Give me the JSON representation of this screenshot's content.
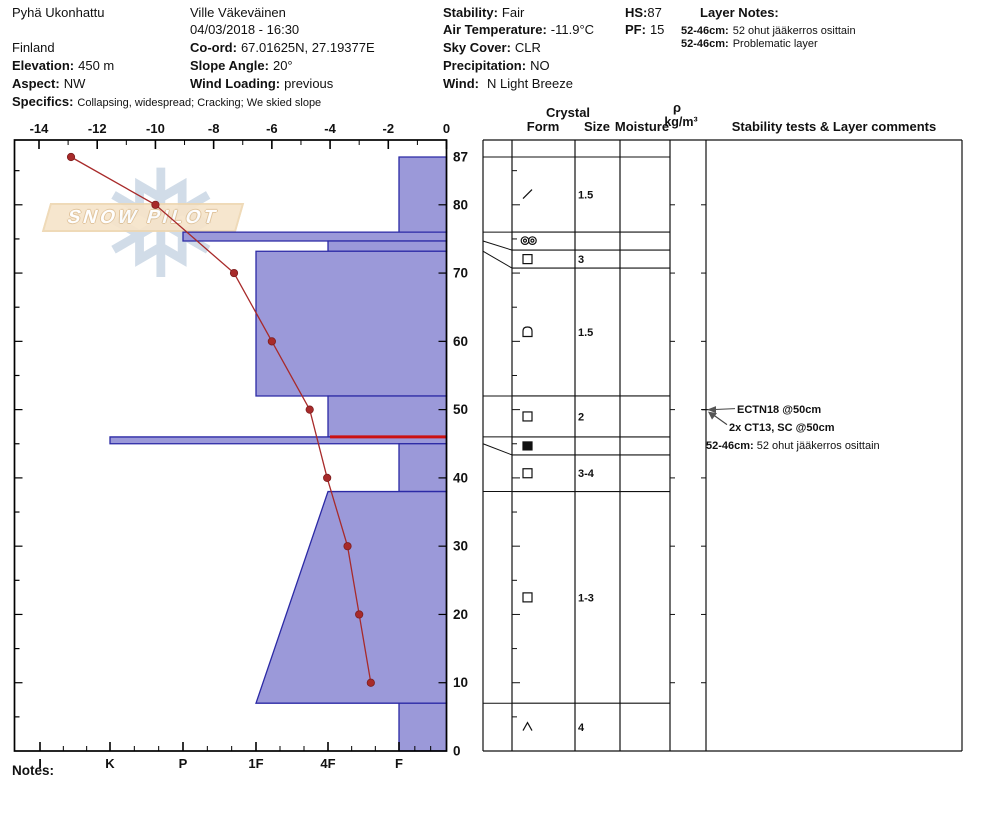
{
  "title_block": {
    "location": "Pyhä Ukonhattu",
    "country": "Finland",
    "elevation_label": "Elevation:",
    "elevation": "450 m",
    "aspect_label": "Aspect:",
    "aspect": "NW",
    "specifics_label": "Specifics:",
    "specifics": "Collapsing, widespread;  Cracking;  We skied slope",
    "observer": "Ville Väkeväinen",
    "datetime": "04/03/2018 - 16:30",
    "coord_label": "Co-ord:",
    "coord": "67.01625N, 27.19377E",
    "slope_angle_label": "Slope Angle:",
    "slope_angle": "20°",
    "wind_loading_label": "Wind Loading:",
    "wind_loading": "previous",
    "stability_label": "Stability:",
    "stability": "Fair",
    "air_temperature_label": "Air Temperature:",
    "air_temperature": "-11.9°C",
    "sky_cover_label": "Sky Cover:",
    "sky_cover": "CLR",
    "precipitation_label": "Precipitation:",
    "precipitation": "NO",
    "wind_label": "Wind:",
    "wind": "N Light Breeze",
    "hs_label": "HS:",
    "hs": "87",
    "pf_label": "PF:",
    "pf": "15",
    "layer_notes_title": "Layer Notes:",
    "layer_notes": [
      {
        "range": "52-46cm:",
        "text": "52 ohut jääkerros osittain"
      },
      {
        "range": "52-46cm:",
        "text": "Problematic layer"
      }
    ]
  },
  "watermark": {
    "text": "SNOW PILOT"
  },
  "notes_label": "Notes:",
  "chart_data": {
    "type": "snow-profile",
    "temperature_axis": {
      "tick_values": [
        -14,
        -12,
        -10,
        -8,
        -6,
        -4,
        -2,
        0
      ],
      "range": [
        -14,
        0
      ],
      "unit": "°C"
    },
    "depth_axis": {
      "tick_values": [
        87,
        80,
        70,
        60,
        50,
        40,
        30,
        20,
        10,
        0
      ],
      "range": [
        0,
        87
      ],
      "unit": "cm"
    },
    "hardness_axis": {
      "categories": [
        "I",
        "K",
        "P",
        "1F",
        "4F",
        "F"
      ]
    },
    "temperature_series": [
      {
        "depth_cm": 87,
        "temp_c": -12.9
      },
      {
        "depth_cm": 80,
        "temp_c": -10.0
      },
      {
        "depth_cm": 70,
        "temp_c": -7.3
      },
      {
        "depth_cm": 60,
        "temp_c": -6.0
      },
      {
        "depth_cm": 50,
        "temp_c": -4.7
      },
      {
        "depth_cm": 40,
        "temp_c": -4.1
      },
      {
        "depth_cm": 30,
        "temp_c": -3.4
      },
      {
        "depth_cm": 20,
        "temp_c": -3.0
      },
      {
        "depth_cm": 10,
        "temp_c": -2.6
      }
    ],
    "hardness_layers": [
      {
        "top_cm": 87,
        "bottom_cm": 76,
        "hardness": "F"
      },
      {
        "top_cm": 76,
        "bottom_cm": 74.7,
        "hardness": "P"
      },
      {
        "top_cm": 74.7,
        "bottom_cm": 73.2,
        "hardness": "4F"
      },
      {
        "top_cm": 73.2,
        "bottom_cm": 52,
        "hardness": "1F"
      },
      {
        "top_cm": 52,
        "bottom_cm": 46,
        "hardness": "4F"
      },
      {
        "top_cm": 46,
        "bottom_cm": 45,
        "hardness": "K"
      },
      {
        "top_cm": 45,
        "bottom_cm": 38,
        "hardness": "F"
      },
      {
        "top_cm": 38,
        "bottom_cm": 7,
        "hardness_top": "4F",
        "hardness_bottom": "1F"
      },
      {
        "top_cm": 7,
        "bottom_cm": 0,
        "hardness": "F"
      }
    ],
    "problem_layer_depth_cm": 46
  },
  "layer_table": {
    "header": {
      "crystal": "Crystal",
      "form": "Form",
      "size": "Size",
      "moisture": "Moisture",
      "rho": "ρ",
      "rho_unit": "kg/m³",
      "comments": "Stability tests & Layer comments"
    },
    "rows": [
      {
        "top_cm": 87,
        "bottom_cm": 76,
        "form": "DF",
        "size": "1.5"
      },
      {
        "top_cm": 76,
        "bottom_cm": 74.7,
        "form": "MFcr",
        "size": ""
      },
      {
        "top_cm": 74.7,
        "bottom_cm": 73.2,
        "form": "FC",
        "size": "3"
      },
      {
        "top_cm": 73.2,
        "bottom_cm": 52,
        "form": "FCxr",
        "size": "1.5"
      },
      {
        "top_cm": 52,
        "bottom_cm": 46,
        "form": "FC",
        "size": "2"
      },
      {
        "top_cm": 46,
        "bottom_cm": 45,
        "form": "IF",
        "size": ""
      },
      {
        "top_cm": 45,
        "bottom_cm": 38,
        "form": "FC",
        "size": "3-4"
      },
      {
        "top_cm": 38,
        "bottom_cm": 7,
        "form": "FC",
        "size": "1-3"
      },
      {
        "top_cm": 7,
        "bottom_cm": 0,
        "form": "DH",
        "size": "4"
      }
    ]
  },
  "stability_tests": [
    {
      "label": "ECTN18 @50cm",
      "depth_cm": 50
    },
    {
      "label": "2x CT13, SC @50cm",
      "depth_cm": 50
    },
    {
      "range": "52-46cm:",
      "text": "52 ohut jääkerros osittain"
    }
  ],
  "colors": {
    "bar_fill": "#9b99d9",
    "bar_border": "#2b29a5",
    "temperature": "#a82a2a",
    "problem_layer": "#cc1111",
    "grid": "#111111"
  }
}
